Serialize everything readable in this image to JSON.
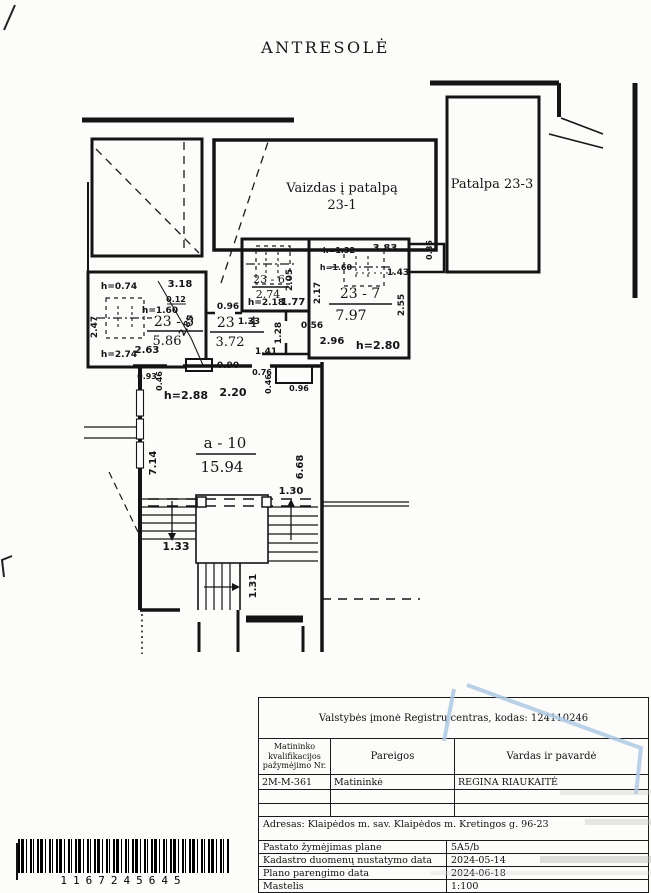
{
  "title": "ANTRESOLĖ",
  "plan": {
    "rooms": {
      "view": {
        "line1": "Vaizdas į patalpą",
        "line2": "23-1"
      },
      "r23_3": {
        "label": "Patalpa 23-3"
      },
      "r23_5": {
        "number": "23 - 5",
        "area": "5.86"
      },
      "r23_4": {
        "number": "23 - 4",
        "area": "3.72"
      },
      "r23_6": {
        "number": "23 - 6",
        "area": "2.74"
      },
      "r23_7": {
        "number": "23 - 7",
        "area": "7.97"
      },
      "a10": {
        "number": "a - 10",
        "area": "15.94"
      }
    },
    "dim": {
      "h074": "h=0.74",
      "w318": "3.18",
      "w012": "0.12",
      "h160a": "h=1.60",
      "v247": "2.47",
      "v285": "2.85",
      "w263": "2.63",
      "h274": "h=2.74",
      "h218": "h=2.18",
      "w177": "1.77",
      "v205": "2.05",
      "w096a": "0.96",
      "w133a": "1.33",
      "v128": "1.28",
      "w141": "1.41",
      "w090": "0.90",
      "h132": "h=1.32",
      "w383": "3.83",
      "h160b": "h=1.60",
      "w143": "1.43",
      "v086": "0.86",
      "v217": "2.17",
      "v255": "2.55",
      "w056": "0.56",
      "w296": "2.96",
      "h280": "h=2.80",
      "w093": "0.93",
      "v046a": "0.46",
      "w076": "0.76",
      "v046b": "0.46",
      "w096b": "0.96",
      "h288": "h=2.88",
      "w220": "2.20",
      "v714": "7.14",
      "v668": "6.68",
      "w130": "1.30",
      "w133b": "1.33",
      "v131": "1.31"
    }
  },
  "table": {
    "org": "Valstybės įmonė Registrų centras, kodas: 124110246",
    "headers": {
      "col1": "Matininko kvalifikacijos pažymėjimo Nr.",
      "col2": "Pareigos",
      "col3": "Vardas ir pavardė"
    },
    "surveyor": {
      "nr": "2M-M-361",
      "position": "Matininkė",
      "name": "REGINA RIAUKAITĖ"
    },
    "address": "Adresas: Klaipėdos m. sav. Klaipėdos m. Kretingos g. 96-23",
    "rows": [
      {
        "label": "Pastato žymėjimas plane",
        "value": "5A5/b"
      },
      {
        "label": "Kadastro duomenų nustatymo data",
        "value": "2024-05-14"
      },
      {
        "label": "Plano parengimo data",
        "value": "2024-06-18"
      },
      {
        "label": "Mastelis",
        "value": "1:100"
      }
    ]
  },
  "barcode": {
    "number": "1167245645"
  }
}
